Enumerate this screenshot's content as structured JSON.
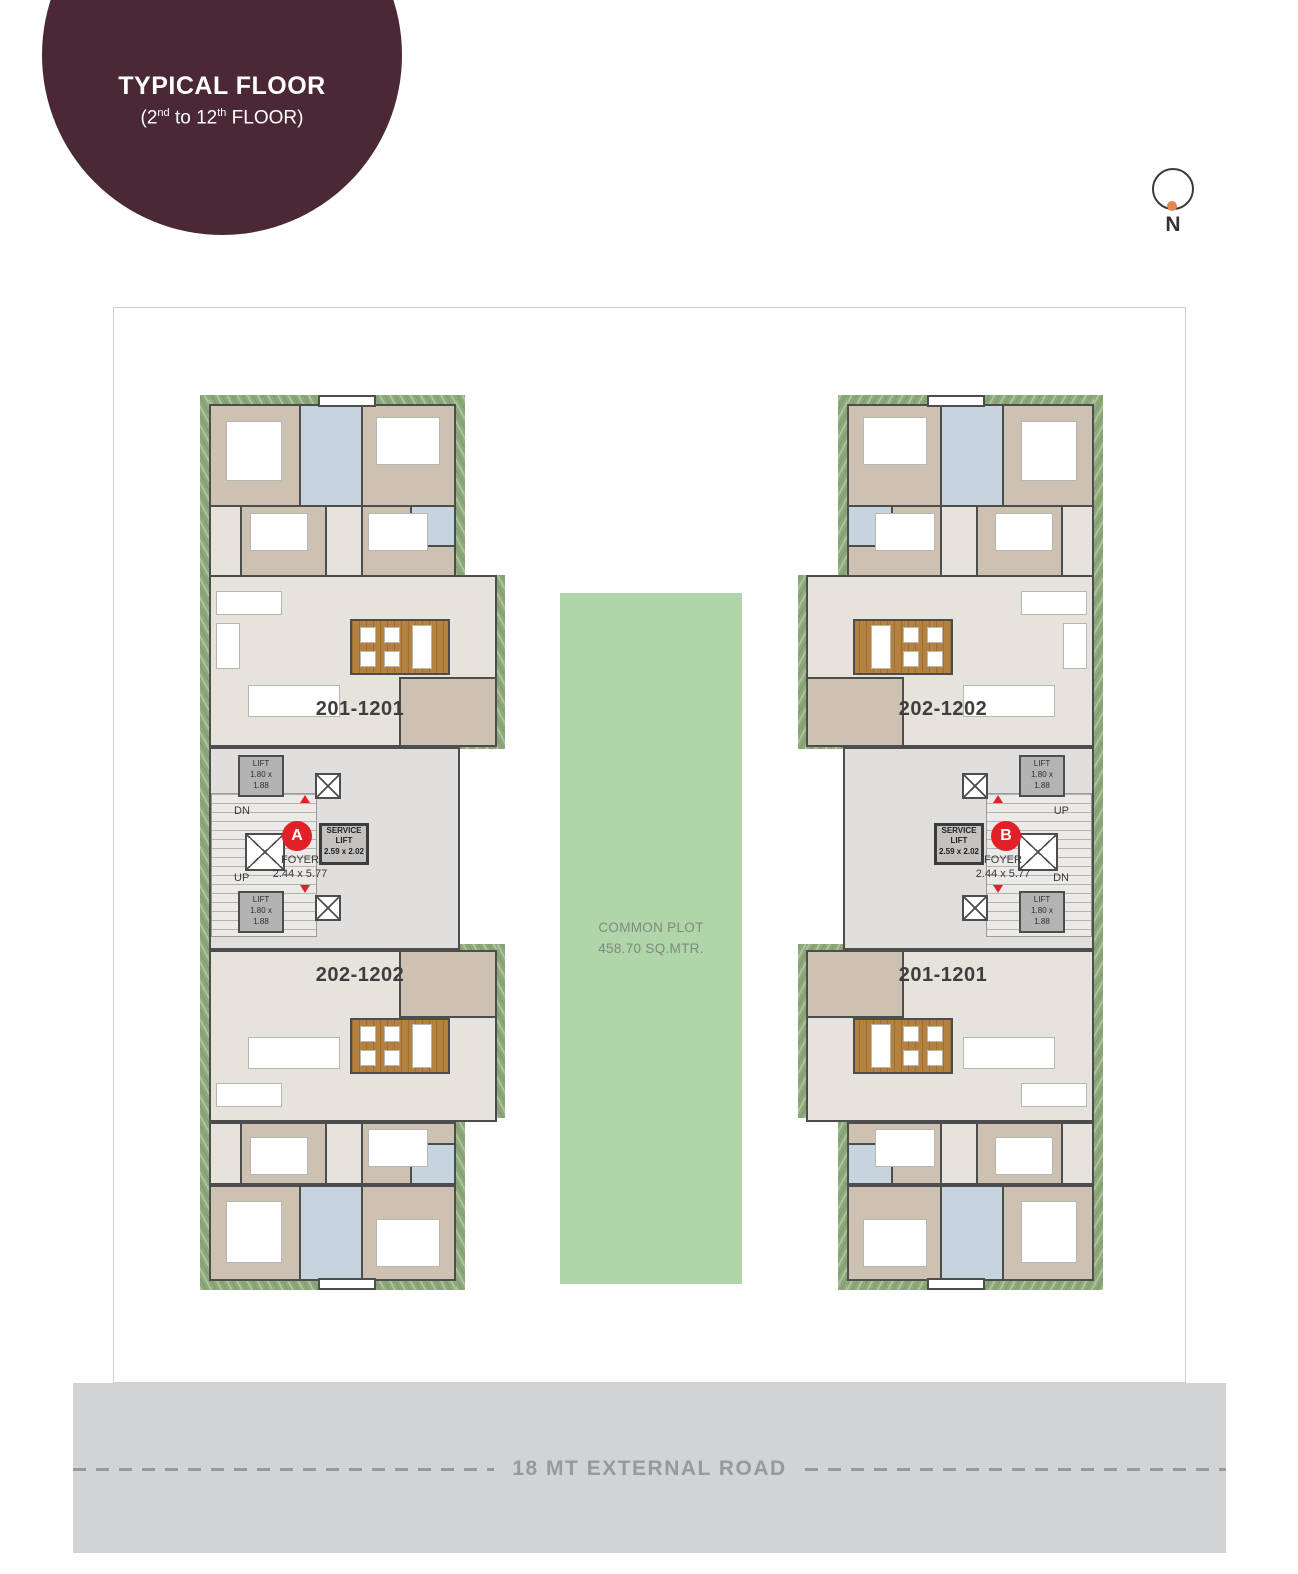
{
  "badge": {
    "title": "TYPICAL FLOOR",
    "subtitle": {
      "p1": "(2",
      "sup1": "nd",
      "p2": " to 12",
      "sup2": "th",
      "p3": " FLOOR)"
    }
  },
  "north": {
    "label": "N"
  },
  "common_plot": {
    "line1": "COMMON PLOT",
    "line2": "458.70 SQ.MTR."
  },
  "road": {
    "label": "18 MT EXTERNAL ROAD"
  },
  "towers": [
    {
      "id": "A",
      "marker": "A",
      "unit_top": "201-1201",
      "unit_bottom": "202-1202",
      "stair_top": "DN",
      "stair_bottom": "UP",
      "lift": {
        "l1": "LIFT",
        "l2": "1.80 x",
        "l3": "1.88"
      },
      "service": {
        "l1": "SERVICE",
        "l2": "LIFT",
        "l3": "2.59 x 2.02"
      },
      "foyer": {
        "l1": "FOYER",
        "l2": "2.44 x 5.77"
      }
    },
    {
      "id": "B",
      "marker": "B",
      "unit_top": "202-1202",
      "unit_bottom": "201-1201",
      "stair_top": "UP",
      "stair_bottom": "DN",
      "lift": {
        "l1": "LIFT",
        "l2": "1.80 x",
        "l3": "1.88"
      },
      "service": {
        "l1": "SERVICE",
        "l2": "LIFT",
        "l3": "2.59 x 2.02"
      },
      "foyer": {
        "l1": "FOYER",
        "l2": "2.44 x 5.77"
      }
    }
  ],
  "colors": {
    "badge_bg": "#4a2836",
    "marker_red": "#e02128",
    "planter": "#8da97a",
    "plot_green": "#b0d5a9",
    "deck": "#b5813f",
    "bed": "#cdc2b2",
    "bath": "#c6d4de",
    "liv": "#e6e3dd",
    "core": "#e0dfdd",
    "wall": "#4d4d4d",
    "road": "#d1d3d4",
    "road_text": "#97999c",
    "north_orange": "#e5854e",
    "label": "#3e3e3e"
  }
}
